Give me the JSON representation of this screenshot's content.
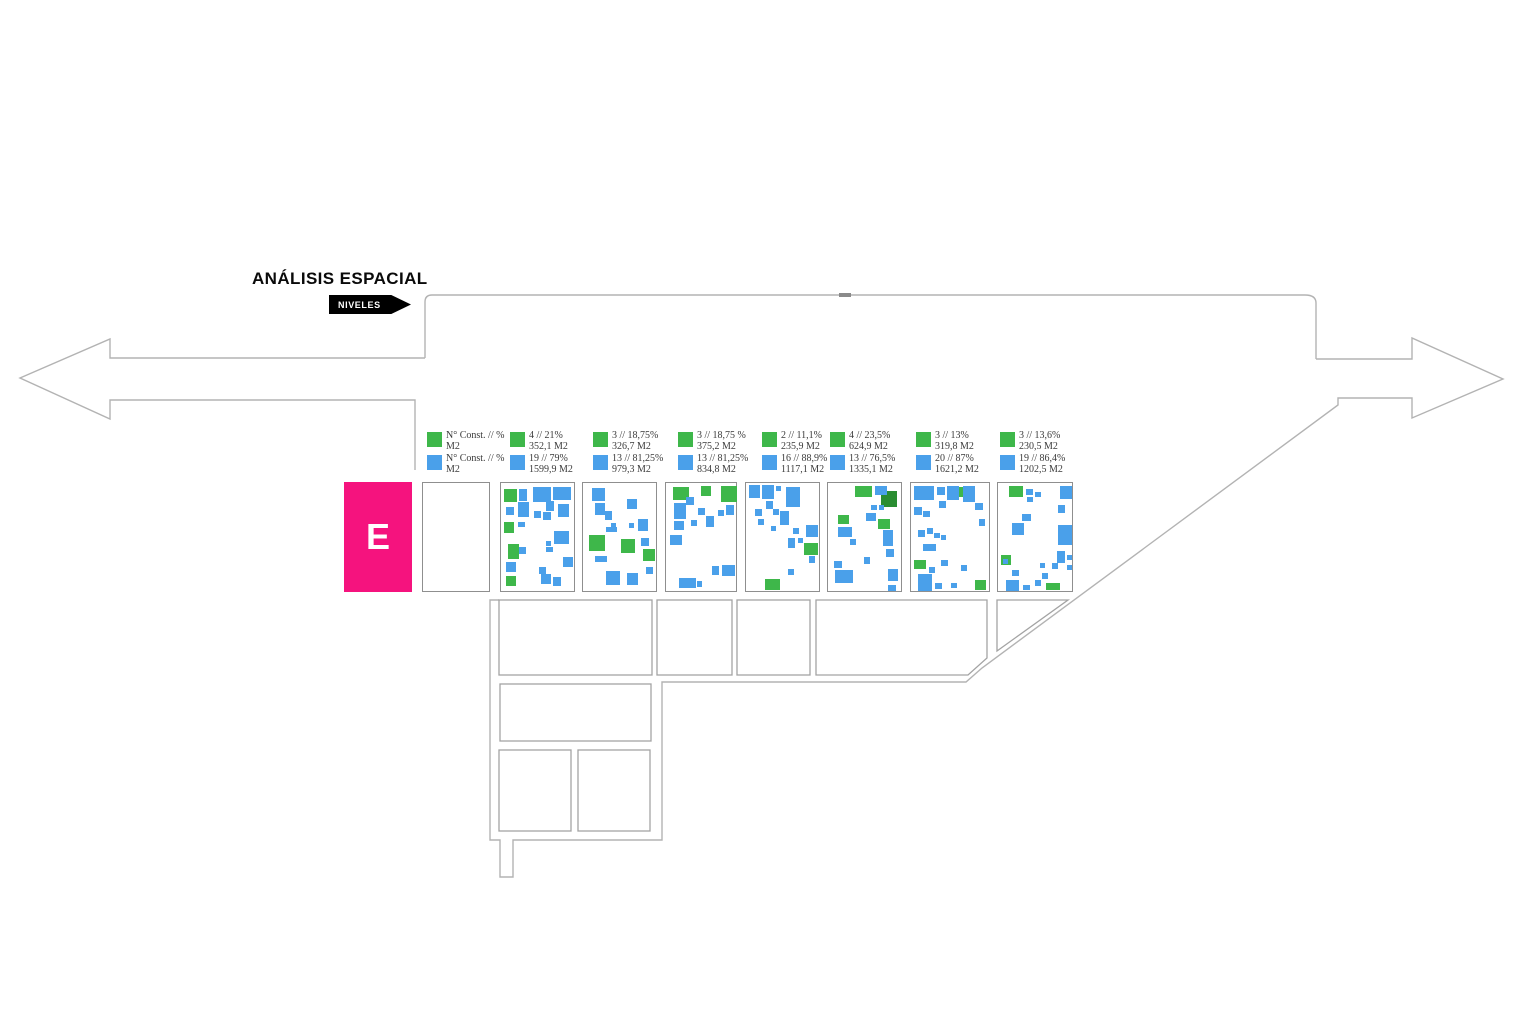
{
  "title": "ANÁLISIS ESPACIAL",
  "tag_label": "NIVELES",
  "level_label": "E",
  "colors": {
    "green": "#3eb74a",
    "dark_green": "#2a8d32",
    "blue": "#4aa0ea",
    "pink": "#f5137e",
    "outline": "#b3b3b3",
    "panel_border": "#8f8f8f",
    "legend_text": "#3a3a3a"
  },
  "legend_header": {
    "green_line1": "N° Const. // %",
    "green_line2": "M2",
    "blue_line1": "N° Const. // %",
    "blue_line2": "M2"
  },
  "panels": [
    {
      "green_line1": "4 // 21%",
      "green_line2": "352,1 M2",
      "blue_line1": "19 // 79%",
      "blue_line2": "1599,9 M2",
      "buildings": [
        [
          3,
          6,
          13,
          13,
          "g"
        ],
        [
          3,
          39,
          10,
          11,
          "g"
        ],
        [
          7,
          61,
          11,
          15,
          "g"
        ],
        [
          5,
          93,
          10,
          10,
          "g"
        ],
        [
          18,
          6,
          8,
          12,
          "b"
        ],
        [
          32,
          4,
          18,
          15,
          "b"
        ],
        [
          52,
          4,
          18,
          13,
          "b"
        ],
        [
          17,
          19,
          11,
          15,
          "b"
        ],
        [
          45,
          18,
          8,
          10,
          "b"
        ],
        [
          57,
          21,
          11,
          13,
          "b"
        ],
        [
          5,
          24,
          8,
          8,
          "b"
        ],
        [
          33,
          28,
          7,
          7,
          "b"
        ],
        [
          42,
          29,
          8,
          8,
          "b"
        ],
        [
          17,
          39,
          7,
          5,
          "b"
        ],
        [
          53,
          48,
          15,
          13,
          "b"
        ],
        [
          45,
          58,
          5,
          5,
          "b"
        ],
        [
          18,
          64,
          7,
          7,
          "b"
        ],
        [
          45,
          64,
          7,
          5,
          "b"
        ],
        [
          5,
          79,
          10,
          10,
          "b"
        ],
        [
          62,
          74,
          10,
          10,
          "b"
        ],
        [
          38,
          84,
          7,
          7,
          "b"
        ],
        [
          40,
          91,
          10,
          10,
          "b"
        ],
        [
          52,
          94,
          8,
          9,
          "b"
        ]
      ]
    },
    {
      "green_line1": "3 // 18,75%",
      "green_line2": "326,7 M2",
      "blue_line1": "13 // 81,25%",
      "blue_line2": "979,3 M2",
      "buildings": [
        [
          6,
          52,
          16,
          16,
          "g"
        ],
        [
          38,
          56,
          14,
          14,
          "g"
        ],
        [
          60,
          66,
          12,
          12,
          "g"
        ],
        [
          9,
          5,
          13,
          13,
          "b"
        ],
        [
          12,
          20,
          10,
          12,
          "b"
        ],
        [
          22,
          28,
          7,
          9,
          "b"
        ],
        [
          44,
          16,
          10,
          10,
          "b"
        ],
        [
          28,
          40,
          5,
          4,
          "b"
        ],
        [
          23,
          44,
          11,
          5,
          "b"
        ],
        [
          46,
          40,
          5,
          5,
          "b"
        ],
        [
          55,
          36,
          10,
          12,
          "b"
        ],
        [
          58,
          55,
          8,
          8,
          "b"
        ],
        [
          12,
          73,
          12,
          6,
          "b"
        ],
        [
          23,
          88,
          14,
          14,
          "b"
        ],
        [
          44,
          90,
          11,
          12,
          "b"
        ],
        [
          63,
          84,
          7,
          7,
          "b"
        ]
      ]
    },
    {
      "green_line1": "3 // 18,75 %",
      "green_line2": "375,2 M2",
      "blue_line1": "13 // 81,25%",
      "blue_line2": "834,8 M2",
      "buildings": [
        [
          7,
          4,
          16,
          13,
          "g"
        ],
        [
          35,
          3,
          10,
          10,
          "g"
        ],
        [
          55,
          3,
          16,
          16,
          "g"
        ],
        [
          8,
          20,
          12,
          16,
          "b"
        ],
        [
          8,
          38,
          10,
          9,
          "b"
        ],
        [
          20,
          14,
          8,
          8,
          "b"
        ],
        [
          32,
          25,
          7,
          7,
          "b"
        ],
        [
          25,
          37,
          6,
          6,
          "b"
        ],
        [
          40,
          33,
          8,
          11,
          "b"
        ],
        [
          52,
          27,
          6,
          6,
          "b"
        ],
        [
          60,
          22,
          8,
          10,
          "b"
        ],
        [
          4,
          52,
          12,
          10,
          "b"
        ],
        [
          46,
          83,
          7,
          9,
          "b"
        ],
        [
          56,
          82,
          13,
          11,
          "b"
        ],
        [
          13,
          95,
          17,
          10,
          "b"
        ],
        [
          31,
          98,
          5,
          6,
          "b"
        ]
      ]
    },
    {
      "green_line1": "2 // 11,1%",
      "green_line2": "235,9 M2",
      "blue_line1": "16 // 88,9%",
      "blue_line2": "1117,1 M2",
      "buildings": [
        [
          19,
          96,
          15,
          11,
          "g"
        ],
        [
          58,
          60,
          14,
          12,
          "g"
        ],
        [
          3,
          2,
          11,
          13,
          "b"
        ],
        [
          16,
          2,
          12,
          14,
          "b"
        ],
        [
          30,
          3,
          5,
          5,
          "b"
        ],
        [
          40,
          4,
          14,
          20,
          "b"
        ],
        [
          20,
          18,
          7,
          8,
          "b"
        ],
        [
          9,
          26,
          7,
          7,
          "b"
        ],
        [
          27,
          26,
          6,
          6,
          "b"
        ],
        [
          34,
          28,
          9,
          14,
          "b"
        ],
        [
          12,
          36,
          6,
          6,
          "b"
        ],
        [
          25,
          43,
          5,
          5,
          "b"
        ],
        [
          47,
          45,
          6,
          6,
          "b"
        ],
        [
          60,
          42,
          12,
          12,
          "b"
        ],
        [
          42,
          55,
          7,
          10,
          "b"
        ],
        [
          52,
          55,
          5,
          5,
          "b"
        ],
        [
          63,
          73,
          6,
          7,
          "b"
        ],
        [
          42,
          86,
          6,
          6,
          "b"
        ]
      ]
    },
    {
      "green_line1": "4 // 23,5%",
      "green_line2": "624,9 M2",
      "blue_line1": "13 // 76,5%",
      "blue_line2": "1335,1 M2",
      "buildings": [
        [
          27,
          3,
          17,
          11,
          "g"
        ],
        [
          10,
          32,
          11,
          9,
          "g"
        ],
        [
          50,
          36,
          12,
          10,
          "g"
        ],
        [
          53,
          8,
          16,
          16,
          "dg"
        ],
        [
          47,
          3,
          12,
          9,
          "b"
        ],
        [
          43,
          22,
          6,
          5,
          "b"
        ],
        [
          51,
          22,
          5,
          5,
          "b"
        ],
        [
          38,
          30,
          10,
          8,
          "b"
        ],
        [
          10,
          44,
          14,
          10,
          "b"
        ],
        [
          22,
          56,
          6,
          6,
          "b"
        ],
        [
          55,
          47,
          10,
          16,
          "b"
        ],
        [
          58,
          66,
          8,
          8,
          "b"
        ],
        [
          36,
          74,
          6,
          7,
          "b"
        ],
        [
          6,
          78,
          8,
          7,
          "b"
        ],
        [
          7,
          87,
          18,
          13,
          "b"
        ],
        [
          60,
          86,
          10,
          12,
          "b"
        ],
        [
          60,
          102,
          8,
          6,
          "b"
        ]
      ]
    },
    {
      "green_line1": "3 // 13%",
      "green_line2": "319,8 M2",
      "blue_line1": "20 // 87%",
      "blue_line2": "1621,2 M2",
      "buildings": [
        [
          42,
          4,
          12,
          10,
          "g"
        ],
        [
          3,
          77,
          12,
          9,
          "g"
        ],
        [
          64,
          97,
          11,
          10,
          "g"
        ],
        [
          3,
          3,
          20,
          14,
          "b"
        ],
        [
          26,
          4,
          8,
          8,
          "b"
        ],
        [
          36,
          3,
          12,
          14,
          "b"
        ],
        [
          52,
          3,
          12,
          16,
          "b"
        ],
        [
          3,
          24,
          8,
          8,
          "b"
        ],
        [
          12,
          28,
          7,
          6,
          "b"
        ],
        [
          28,
          18,
          7,
          7,
          "b"
        ],
        [
          64,
          20,
          8,
          7,
          "b"
        ],
        [
          68,
          36,
          6,
          7,
          "b"
        ],
        [
          7,
          47,
          7,
          7,
          "b"
        ],
        [
          16,
          45,
          6,
          6,
          "b"
        ],
        [
          23,
          50,
          6,
          5,
          "b"
        ],
        [
          30,
          52,
          5,
          5,
          "b"
        ],
        [
          12,
          61,
          13,
          7,
          "b"
        ],
        [
          30,
          77,
          7,
          6,
          "b"
        ],
        [
          18,
          84,
          6,
          6,
          "b"
        ],
        [
          7,
          91,
          14,
          17,
          "b"
        ],
        [
          24,
          100,
          7,
          6,
          "b"
        ],
        [
          40,
          100,
          6,
          5,
          "b"
        ],
        [
          50,
          82,
          6,
          6,
          "b"
        ]
      ]
    },
    {
      "green_line1": "3 // 13,6%",
      "green_line2": "230,5 M2",
      "blue_line1": "19 // 86,4%",
      "blue_line2": "1202,5 M2",
      "buildings": [
        [
          11,
          3,
          14,
          11,
          "g"
        ],
        [
          3,
          72,
          10,
          10,
          "g"
        ],
        [
          48,
          100,
          14,
          7,
          "g"
        ],
        [
          28,
          6,
          7,
          6,
          "b"
        ],
        [
          37,
          9,
          6,
          5,
          "b"
        ],
        [
          29,
          14,
          6,
          5,
          "b"
        ],
        [
          62,
          3,
          12,
          13,
          "b"
        ],
        [
          60,
          22,
          7,
          8,
          "b"
        ],
        [
          24,
          31,
          9,
          7,
          "b"
        ],
        [
          14,
          40,
          12,
          12,
          "b"
        ],
        [
          60,
          42,
          14,
          20,
          "b"
        ],
        [
          5,
          76,
          5,
          5,
          "b"
        ],
        [
          14,
          87,
          7,
          6,
          "b"
        ],
        [
          8,
          97,
          13,
          11,
          "b"
        ],
        [
          25,
          102,
          7,
          5,
          "b"
        ],
        [
          37,
          97,
          6,
          6,
          "b"
        ],
        [
          44,
          90,
          6,
          6,
          "b"
        ],
        [
          54,
          80,
          6,
          6,
          "b"
        ],
        [
          59,
          68,
          8,
          12,
          "b"
        ],
        [
          69,
          72,
          5,
          5,
          "b"
        ],
        [
          69,
          82,
          5,
          5,
          "b"
        ],
        [
          42,
          80,
          5,
          5,
          "b"
        ]
      ]
    }
  ]
}
